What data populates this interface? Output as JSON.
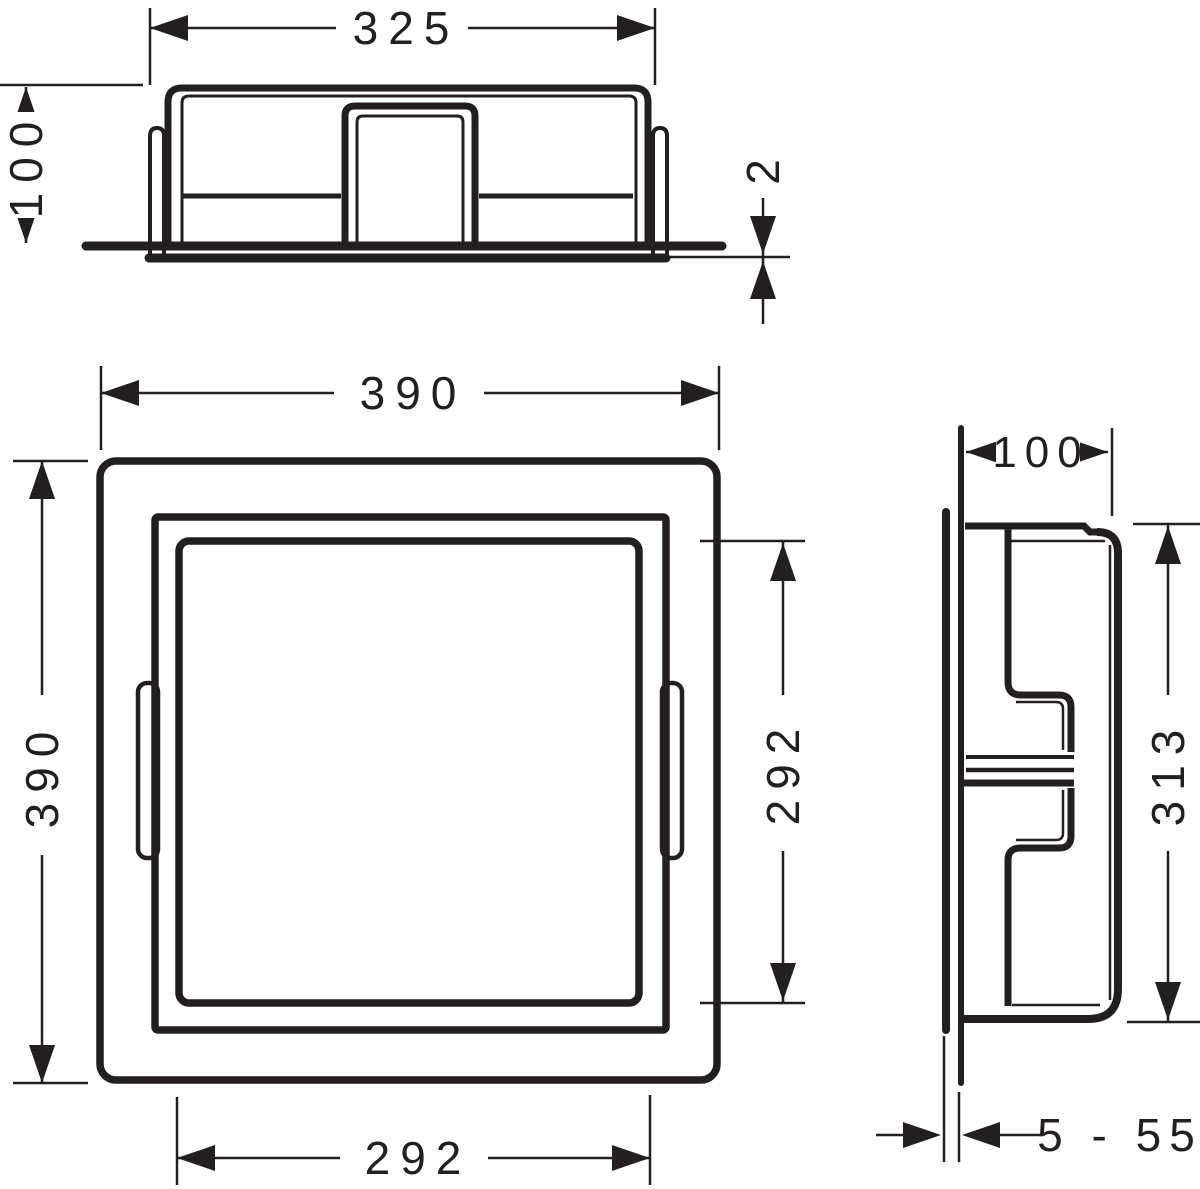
{
  "drawing": {
    "type": "technical-dimension-drawing",
    "background_color": "#ffffff",
    "line_color": "#231f20",
    "units": "mm",
    "top_view": {
      "width": "325",
      "height": "100",
      "flange_thickness": "2"
    },
    "front_view": {
      "outer_width": "390",
      "outer_height": "390",
      "inner_width": "292",
      "inner_height": "292"
    },
    "side_view": {
      "depth": "100",
      "height": "313",
      "tile_thickness_range": "5 - 55"
    }
  }
}
